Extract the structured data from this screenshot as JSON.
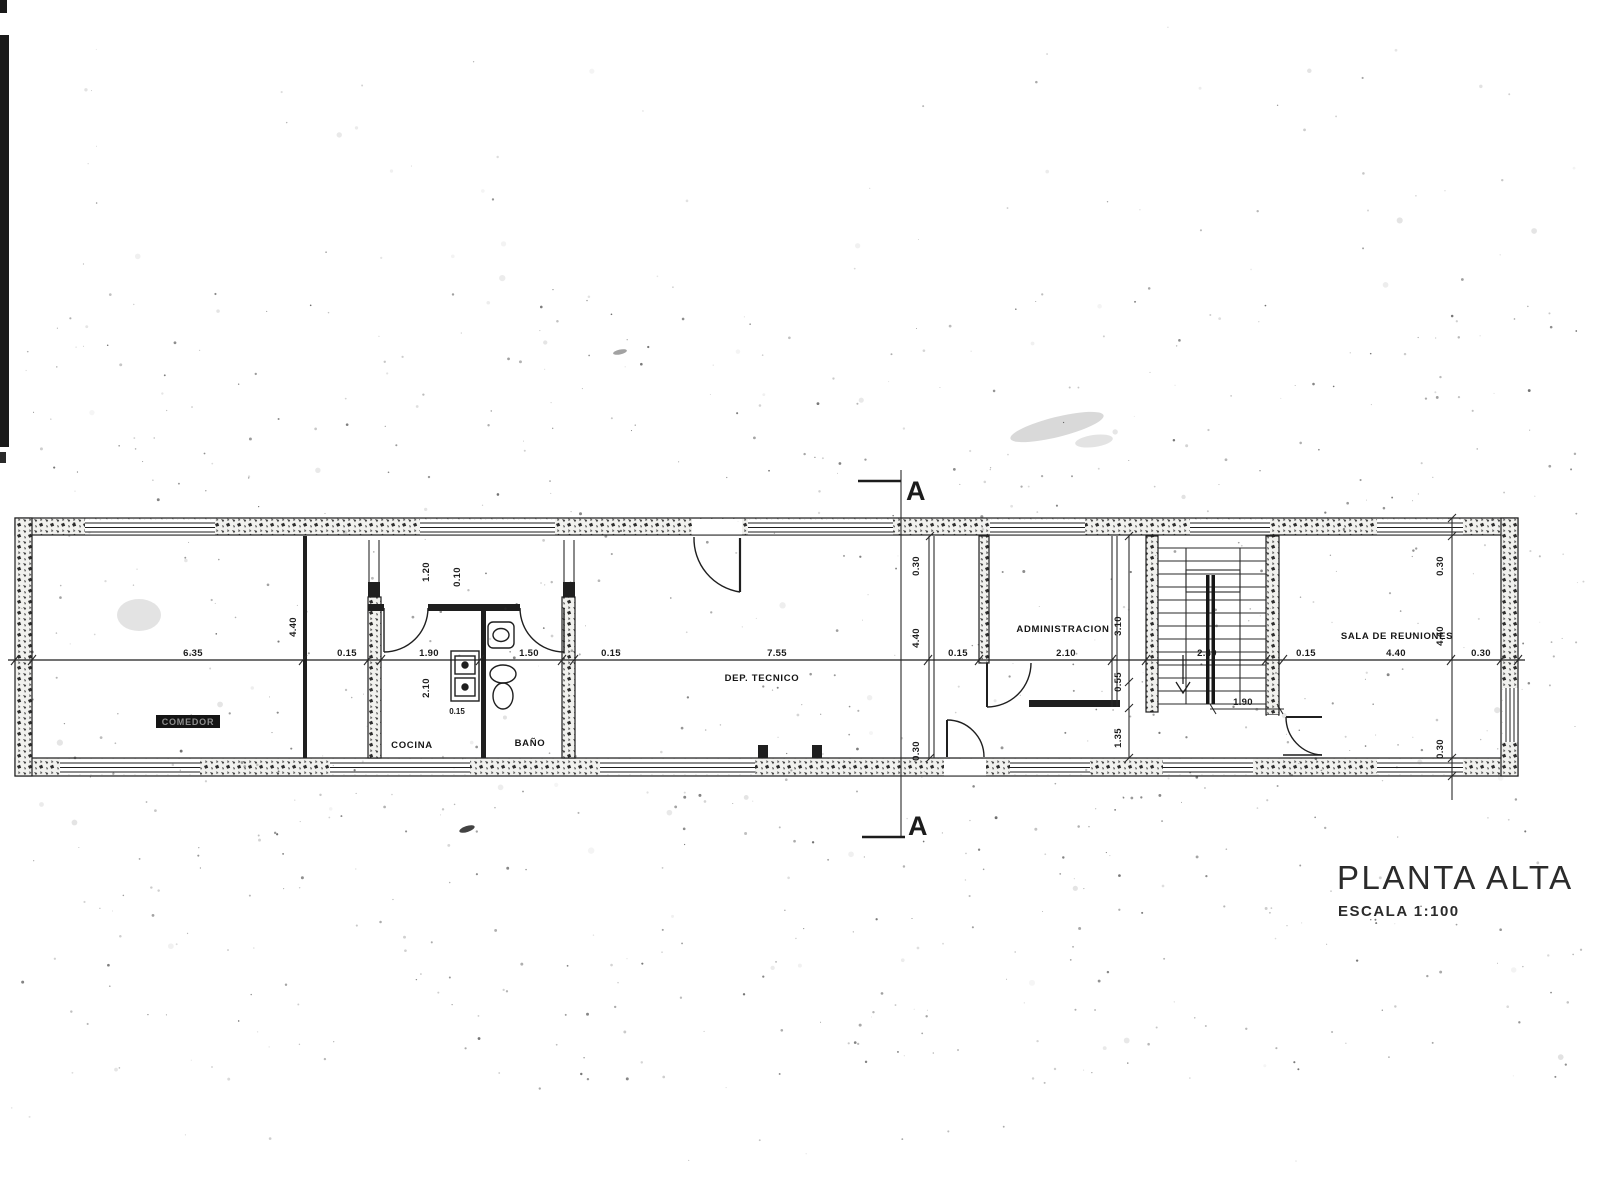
{
  "drawing": {
    "title": "PLANTA ALTA",
    "scale_label": "ESCALA 1:100",
    "section_letter": "A"
  },
  "rooms": {
    "comedor": "COMEDOR",
    "cocina": "COCINA",
    "bano": "BAÑO",
    "dep_tecnico": "DEP. TECNICO",
    "administracion": "ADMINISTRACION",
    "sala_reuniones": "SALA DE REUNIONES"
  },
  "dims": {
    "h": [
      "6.35",
      "0.15",
      "1.90",
      "1.50",
      "0.15",
      "7.55",
      "0.15",
      "2.10",
      "2.40",
      "0.15",
      "4.40",
      "0.30"
    ],
    "v_left": [
      "4.40"
    ],
    "v_mid": [
      "0.30",
      "4.40",
      "0.30"
    ],
    "v_right": [
      "0.30",
      "4.40",
      "0.30"
    ],
    "v_admin": [
      "3.10",
      "0.55",
      "1.35"
    ],
    "v_cocina": [
      "1.20",
      "0.10",
      "2.10"
    ],
    "cocina_wall": "0.15",
    "stair_width": "1.90"
  }
}
